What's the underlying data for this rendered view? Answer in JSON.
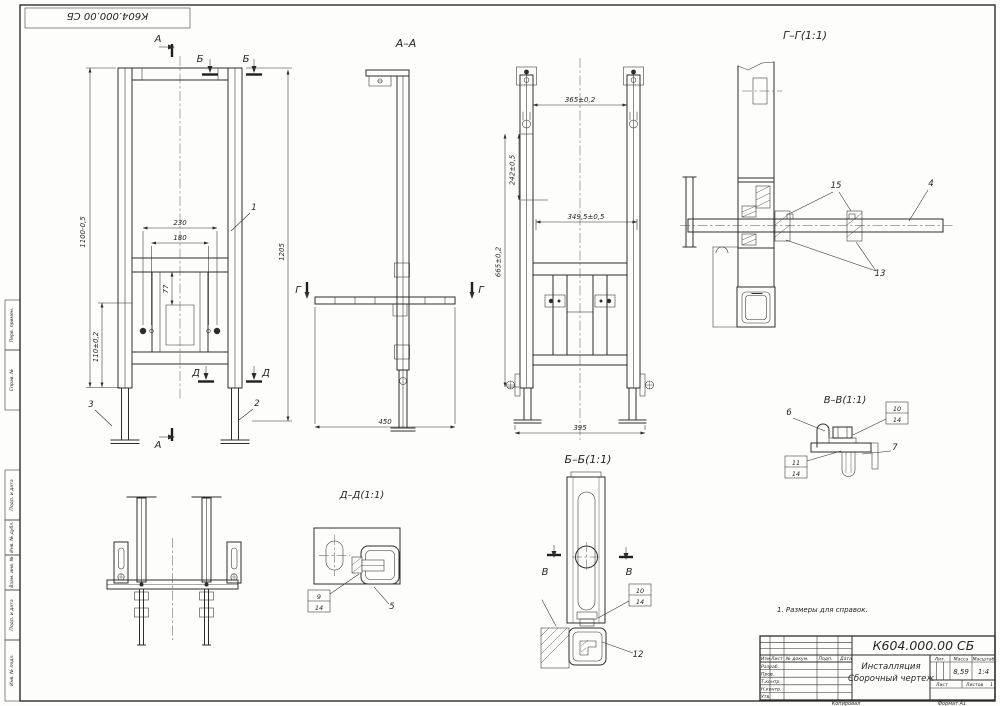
{
  "sheet": {
    "corner_ref": "К604.000.00 СБ",
    "note": "1. Размеры для справок.",
    "kopiroval": "Копировал",
    "format": "Формат  А1"
  },
  "margin_stamps": {
    "perv_primen": "Перв. примен.",
    "sprav_no": "Справ. №",
    "podp_data1": "Подп. и дата",
    "inv_dubl": "Инв. № дубл.",
    "vzam_inv": "Взам. инв. №",
    "podp_data2": "Подп. и дата",
    "inv_podl": "Инв. № подл."
  },
  "title_block": {
    "doc_number": "К604.000.00 СБ",
    "name": "Инсталляция",
    "doc_type": "Сборочный чертеж",
    "col_izm": "Изм.",
    "col_list": "Лист",
    "col_docnum": "№ докум.",
    "col_podp": "Подп.",
    "col_data": "Дата",
    "row_razrab": "Разраб.",
    "row_prov": "Пров.",
    "row_tkontr": "Т.контр.",
    "row_nkontr": "Н.контр.",
    "row_utv": "Утв.",
    "lit_label": "Лит.",
    "mass_label": "Масса",
    "scale_label": "Масштаб",
    "mass_value": "8,59",
    "scale_value": "1:4",
    "list_label": "Лист",
    "listov_label": "Листов",
    "listov_value": "1"
  },
  "front_view": {
    "mark_a": "А",
    "mark_b": "Б",
    "mark_d": "Д",
    "dim_width_outer": "230",
    "dim_width_inner": "180",
    "dim_offset": "77",
    "dim_height_frame": "1100-0,5",
    "dim_height_lower": "110±0,2",
    "dim_height_total": "1205",
    "pos_1": "1",
    "pos_2": "2",
    "pos_3": "3"
  },
  "section_aa": {
    "label": "А–А",
    "mark_g": "Г",
    "dim_depth": "450"
  },
  "view_bb": {
    "dim_top": "365±0,2",
    "dim_side": "242±0,5",
    "dim_mid": "349,5±0,5",
    "dim_height": "665±0,2",
    "dim_bottom": "395",
    "label": "Б–Б(1:1)"
  },
  "section_gg": {
    "label": "Г–Г(1:1)",
    "pos_15": "15",
    "pos_4": "4",
    "pos_13": "13"
  },
  "section_vv": {
    "label": "В–В(1:1)",
    "pos_6": "6",
    "pos_10": "10",
    "pos_14": "14",
    "pos_7": "7",
    "pos_11": "11"
  },
  "section_dd": {
    "label": "Д–Д(1:1)",
    "pos_9": "9",
    "pos_14": "14",
    "pos_5": "5"
  },
  "detail_bb": {
    "mark_v": "В",
    "pos_10": "10",
    "pos_14": "14",
    "pos_12": "12"
  }
}
